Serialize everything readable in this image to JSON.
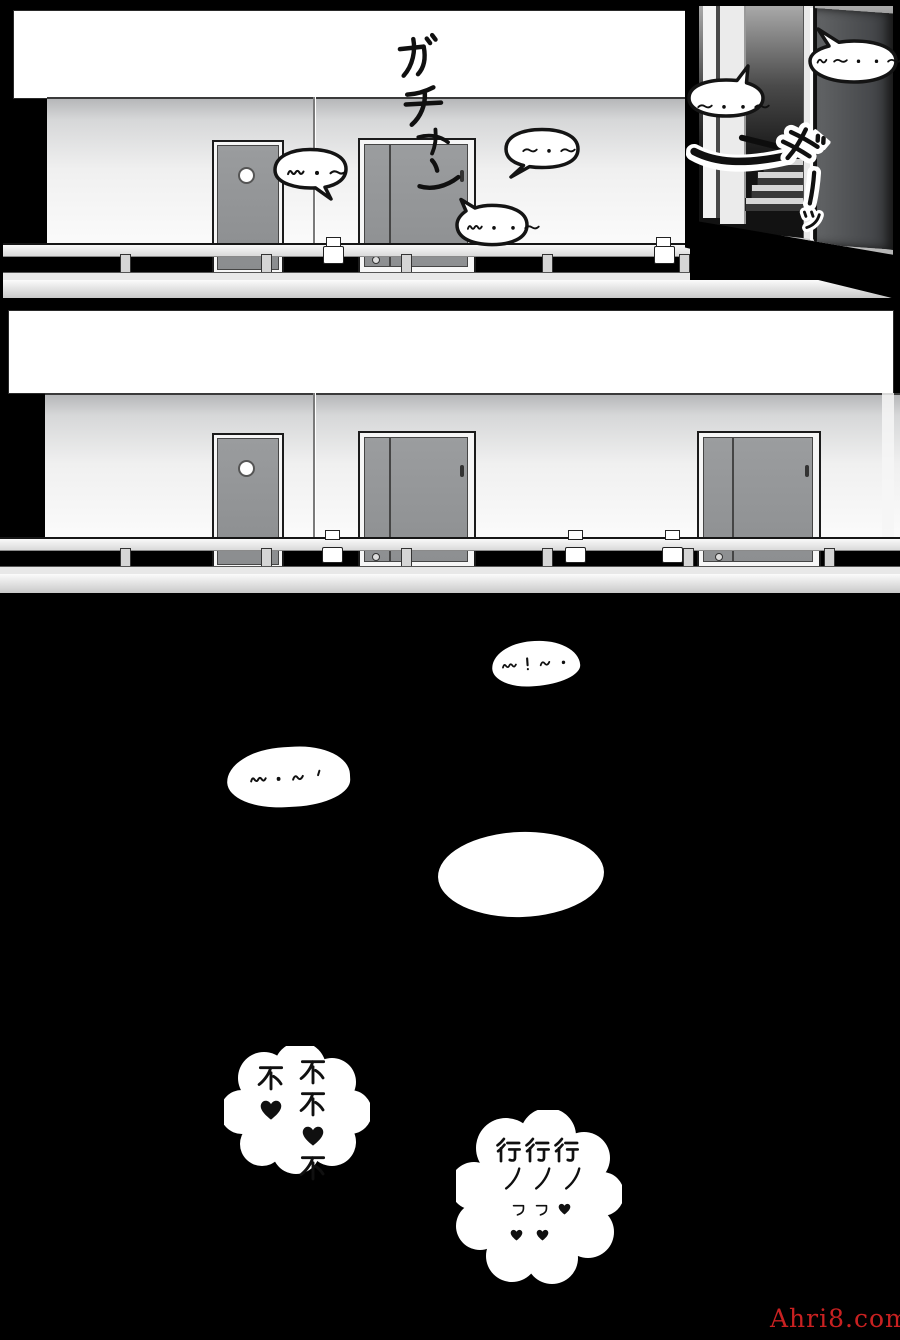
{
  "watermark": {
    "text": "Ahri8.com",
    "color": "#c92121"
  },
  "colors": {
    "ink": "#111111",
    "paper": "#ffffff",
    "door_gray": "#8f9193",
    "background": "#000000"
  },
  "panel1": {
    "sfx_door_slam": "ガチャン",
    "sfx_door_creak": "ギーッ",
    "bubbles": {
      "wall": "w·~",
      "upper": "~·~",
      "lower": "w··~",
      "inset_left": "~··~",
      "inset_right": "n~··~"
    }
  },
  "panel3": {
    "bubble_top": "w!n·",
    "bubble_mid": "w·n'",
    "cloud_no": {
      "col_right": "不不♥不",
      "col_left": "不♥"
    },
    "cloud_ok": {
      "lines": [
        "行行行",
        "ノノノ",
        "ヮヮ♥",
        "♥♥"
      ]
    }
  }
}
